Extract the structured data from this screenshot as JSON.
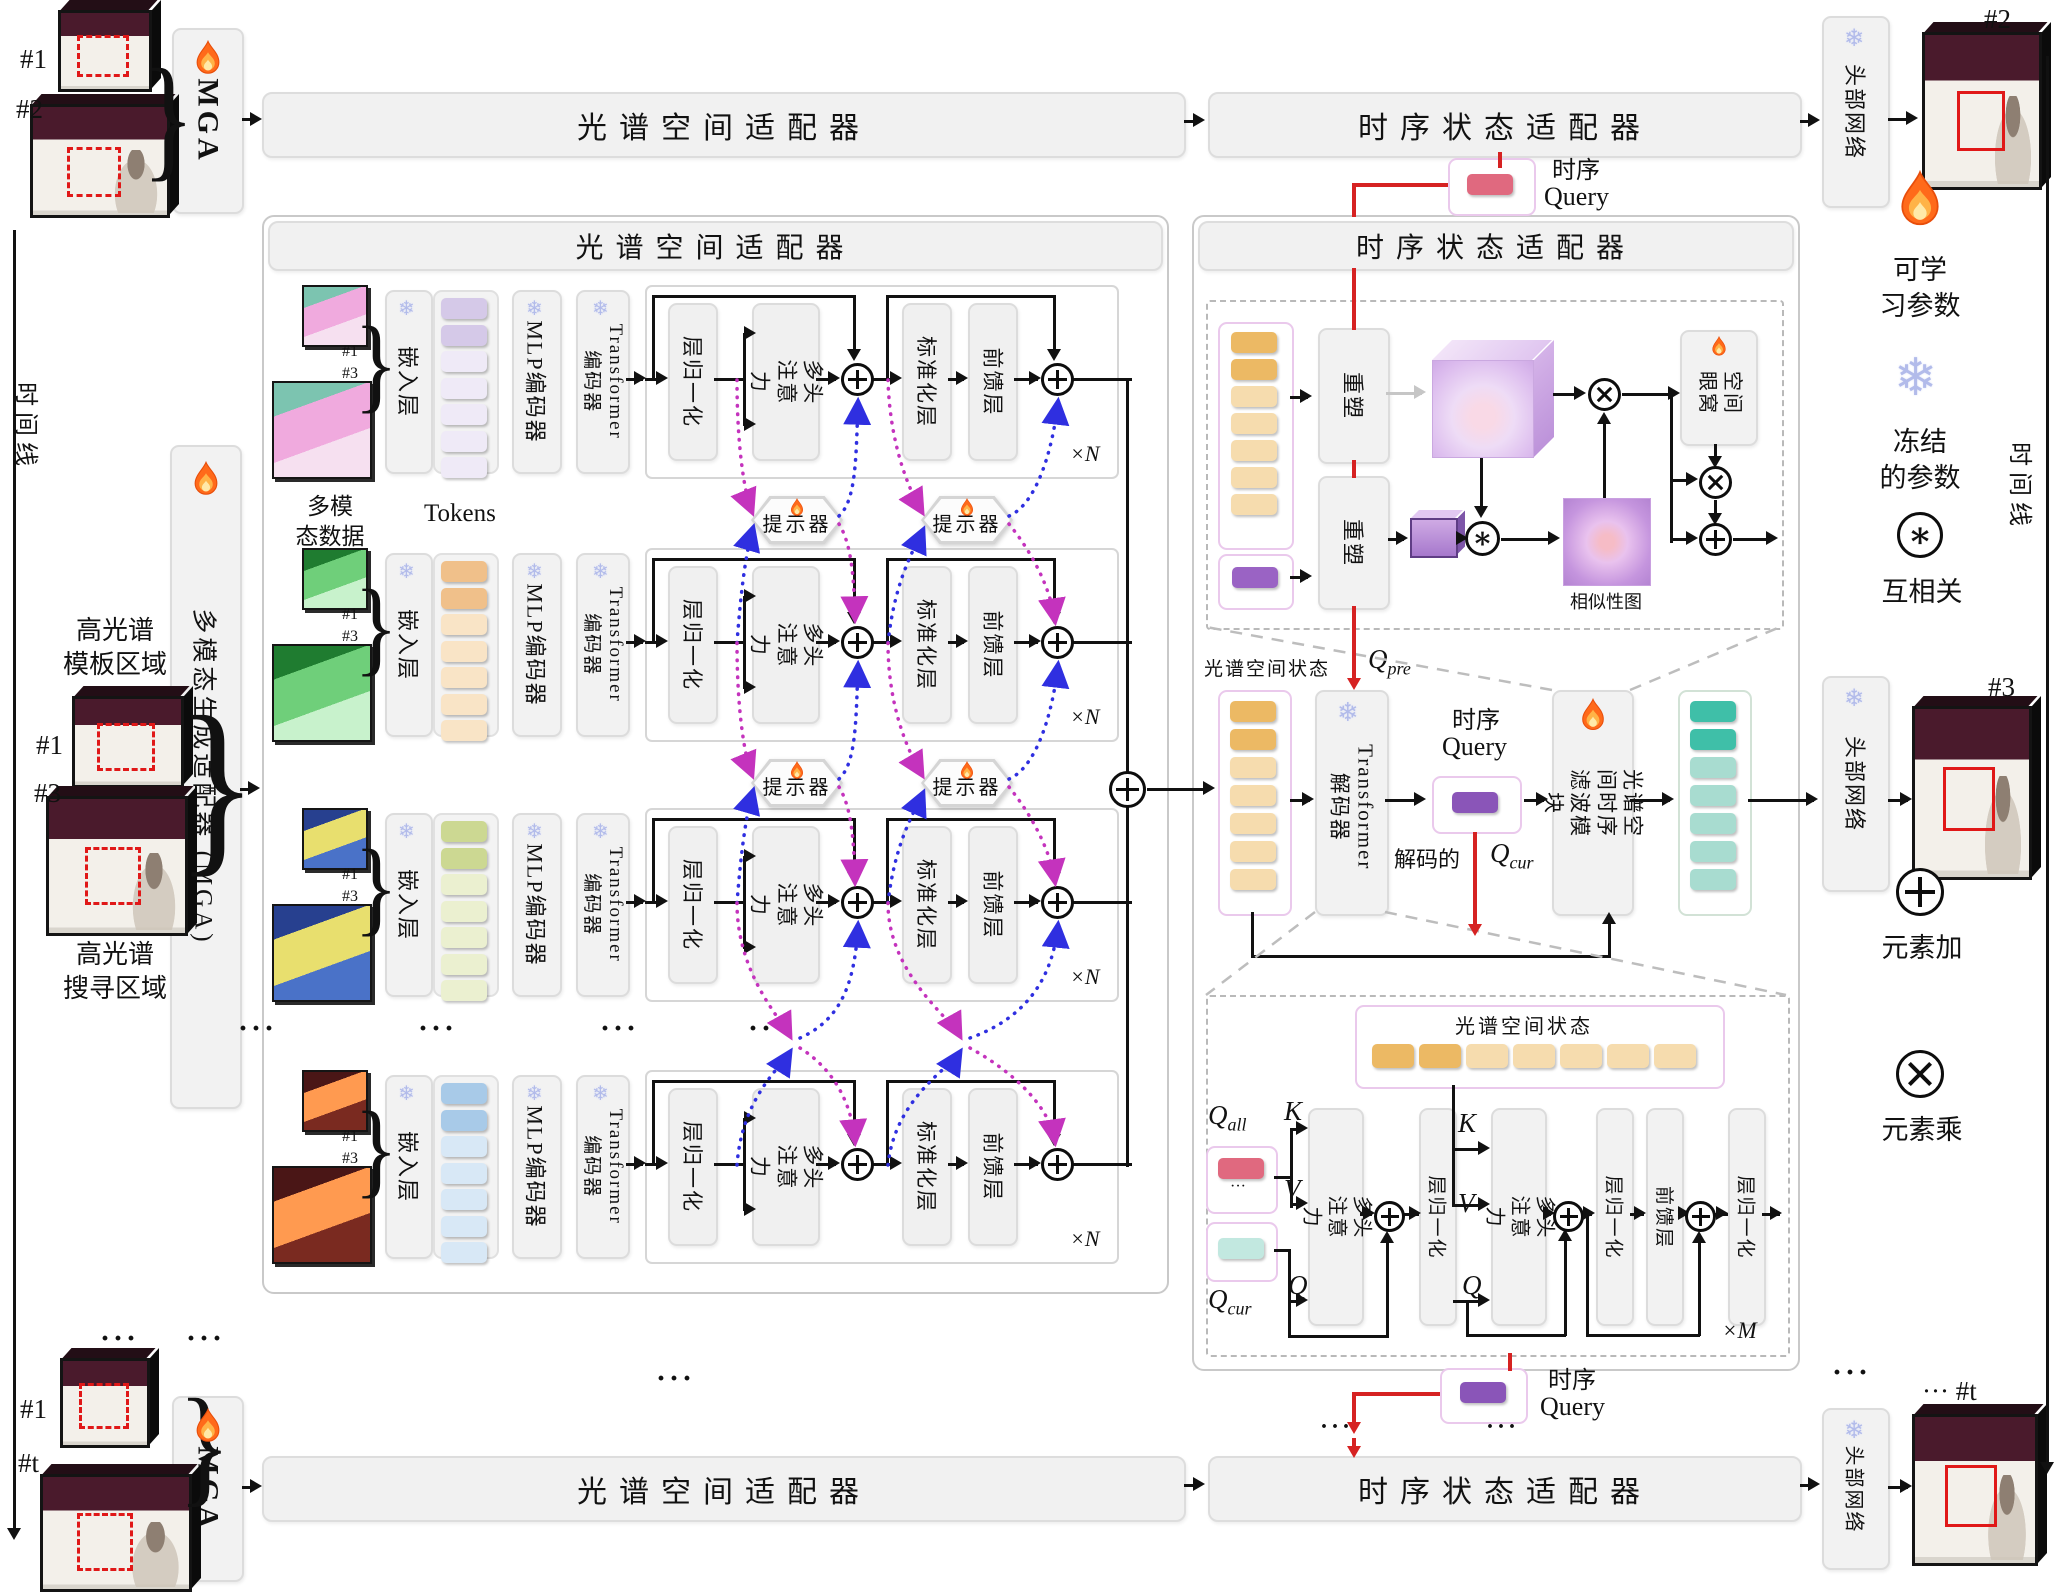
{
  "labels": {
    "spectral_adapter": "光谱空间适配器",
    "temporal_adapter": "时序状态适配器",
    "head_network": "头部网络",
    "mga": "MGA",
    "mga_full": "多模态生成适配器 (MGA)",
    "timeline": "时间线",
    "learnable_1": "可学",
    "learnable_2": "习参数",
    "frozen_1": "冻结",
    "frozen_2": "的参数",
    "cross_corr": "互相关",
    "elem_add": "元素加",
    "elem_mul": "元素乘",
    "hsi_template_1": "高光谱",
    "hsi_template_2": "模板区域",
    "hsi_search_1": "高光谱",
    "hsi_search_2": "搜寻区域",
    "multimodal_1": "多模",
    "multimodal_2": "态数据",
    "tokens": "Tokens",
    "embed": "嵌入层",
    "mlp_encoder": "MLP编码器",
    "tr_enc_1": "Transformer",
    "tr_enc_2": "编码器",
    "layer_norm": "层归一化",
    "mha_1": "多头",
    "mha_2": "注意力",
    "norm_layer": "标准化层",
    "ffn": "前馈层",
    "xN": "×N",
    "xM": "×M",
    "prompter": "提示器",
    "reshape": "重塑",
    "spatial_mask_1": "空间",
    "spatial_mask_2": "眼窝",
    "similarity_map": "相似性图",
    "spectral_state": "光谱空间状态",
    "tr_dec_1": "Transformer",
    "tr_dec_2": "解码器",
    "tq_zh": "时序",
    "tq_en": "Query",
    "decoded": "解码的",
    "q": "Q",
    "sub_pre": "pre",
    "sub_cur": "cur",
    "sub_all": "all",
    "k": "K",
    "v": "V",
    "filter_1": "光谱空间时序",
    "filter_2": "滤波模块",
    "ellipsis": "···"
  },
  "frames": {
    "f1": "#1",
    "f2": "#2",
    "f3": "#3",
    "ft": "#t",
    "ft_out": "··· #t"
  },
  "icons": {
    "flame": "learnable-flame",
    "snow": "❄"
  },
  "colors": {
    "accent_red": "#d62222",
    "prompt_magenta": "#c433bd",
    "prompt_blue": "#2f2fe0",
    "state_token_orange": "#f0c08a",
    "query_token_pink": "#e0697f",
    "query_token_purple": "#9a63c4",
    "query_token_teal": "#c2e8e0",
    "output_token_teal": "#3fbfa8",
    "panel_gray": "#f1f1f1"
  },
  "rows": [
    {
      "name": "modality-1",
      "tok_strong": "#d5c9e8",
      "tok_light": "#efeaf7",
      "img_a": "#7cc4b0",
      "img_b": "#f0aade",
      "img_c": "#f6e0f0"
    },
    {
      "name": "modality-2",
      "tok_strong": "#f0c08a",
      "tok_light": "#f9e4c6",
      "img_a": "#1f7c30",
      "img_b": "#6fcf7a",
      "img_c": "#c8f2cc"
    },
    {
      "name": "modality-3",
      "tok_strong": "#ccd892",
      "tok_light": "#ebf0d0",
      "img_a": "#27408f",
      "img_b": "#e8df6e",
      "img_c": "#4a72c8"
    },
    {
      "name": "modality-4",
      "tok_strong": "#a8cae8",
      "tok_light": "#d8e8f6",
      "img_a": "#4a1616",
      "img_b": "#ff9a50",
      "img_c": "#7a2a20"
    }
  ]
}
